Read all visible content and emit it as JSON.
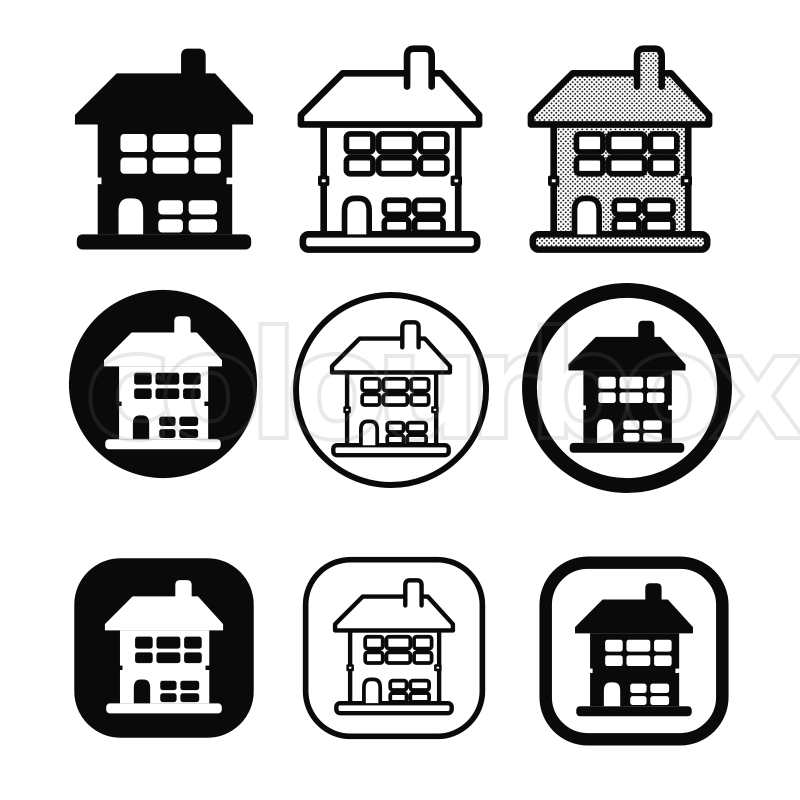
{
  "title": "Simple house icon sign symbol set",
  "colors": {
    "ink": "#0a0a0a",
    "paper": "#ffffff",
    "watermark_stroke": "rgba(125,125,125,0.17)"
  },
  "watermark": {
    "text": "colourbox"
  },
  "icons": [
    {
      "id": "house-icon-solid",
      "label": "solid black house icon",
      "container": "none",
      "house_style": "solid"
    },
    {
      "id": "house-icon-outline",
      "label": "outline house icon",
      "container": "none",
      "house_style": "outline"
    },
    {
      "id": "house-icon-dotted",
      "label": "halftone dot pattern house icon",
      "container": "none",
      "house_style": "dotted"
    },
    {
      "id": "house-icon-circle-filled",
      "label": "white house on filled black circle",
      "container": "circle-filled",
      "house_style": "inverted"
    },
    {
      "id": "house-icon-circle-outline",
      "label": "outline house in thin outline circle",
      "container": "circle-thin",
      "house_style": "outline"
    },
    {
      "id": "house-icon-circle-thick",
      "label": "solid black house in thick outline circle",
      "container": "circle-thick",
      "house_style": "solid"
    },
    {
      "id": "house-icon-rounded-square-filled",
      "label": "white house on filled black rounded square",
      "container": "square-filled",
      "house_style": "inverted"
    },
    {
      "id": "house-icon-rounded-square-outline",
      "label": "outline house in thin rounded square",
      "container": "square-thin",
      "house_style": "outline"
    },
    {
      "id": "house-icon-rounded-square-thick",
      "label": "solid black house in thick rounded square",
      "container": "square-thick",
      "house_style": "solid"
    }
  ]
}
